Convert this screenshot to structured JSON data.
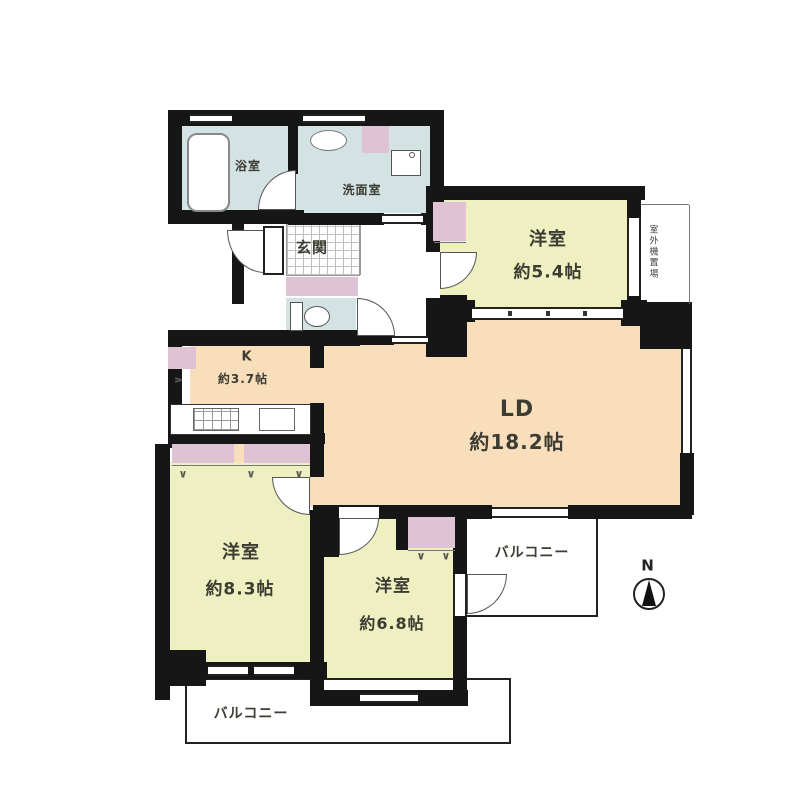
{
  "title": "apartment-floor-plan",
  "rooms": {
    "bath": {
      "label": "浴室"
    },
    "washroom": {
      "label": "洗面室"
    },
    "entrance": {
      "label": "玄関"
    },
    "kitchen": {
      "label": "K",
      "size": "約3.7帖"
    },
    "living_dining": {
      "label": "LD",
      "size": "約18.2帖"
    },
    "western_room_1": {
      "label": "洋室",
      "size": "約5.4帖"
    },
    "western_room_2": {
      "label": "洋室",
      "size": "約8.3帖"
    },
    "western_room_3": {
      "label": "洋室",
      "size": "約6.8帖"
    },
    "balcony_side": {
      "label": "バルコニー"
    },
    "balcony_bottom": {
      "label": "バルコニー"
    },
    "outdoor_unit_space": {
      "label": "室外機置場"
    }
  },
  "compass": {
    "north_label": "N"
  },
  "colors": {
    "wall": "#161616",
    "room-yellow": "#eef0c1",
    "living-peach": "#f8debb",
    "wet-blue": "#d3e3e3",
    "closet-pink": "#dfc2d3",
    "line": "#555555"
  }
}
